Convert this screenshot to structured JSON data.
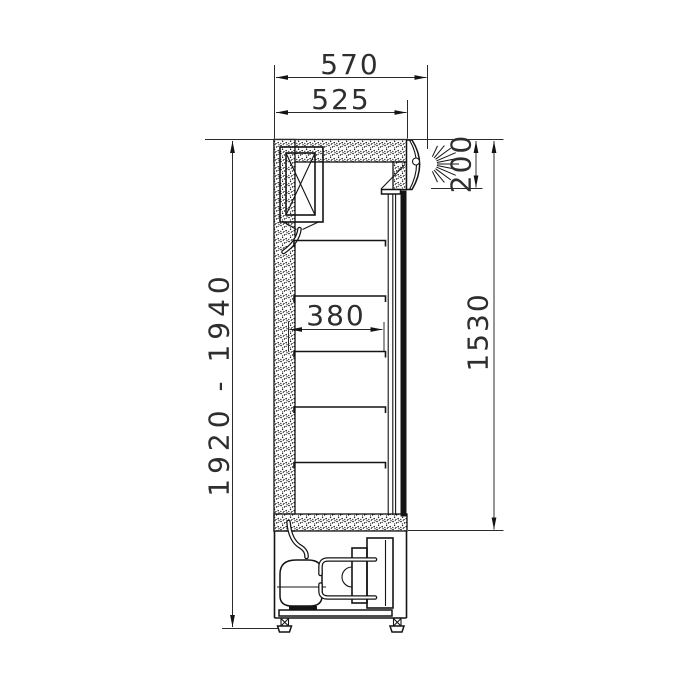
{
  "colors": {
    "background": "#ffffff",
    "line": "#141414",
    "dimension_text": "#2e2e2e"
  },
  "drawing_type": "refrigerated-display-cabinet-side-section",
  "dimensions": {
    "overall_depth": "570",
    "cabinet_depth": "525",
    "canopy_height": "200",
    "interior_height": "1530",
    "shelf_depth": "380",
    "overall_height": "1920 - 1940"
  }
}
